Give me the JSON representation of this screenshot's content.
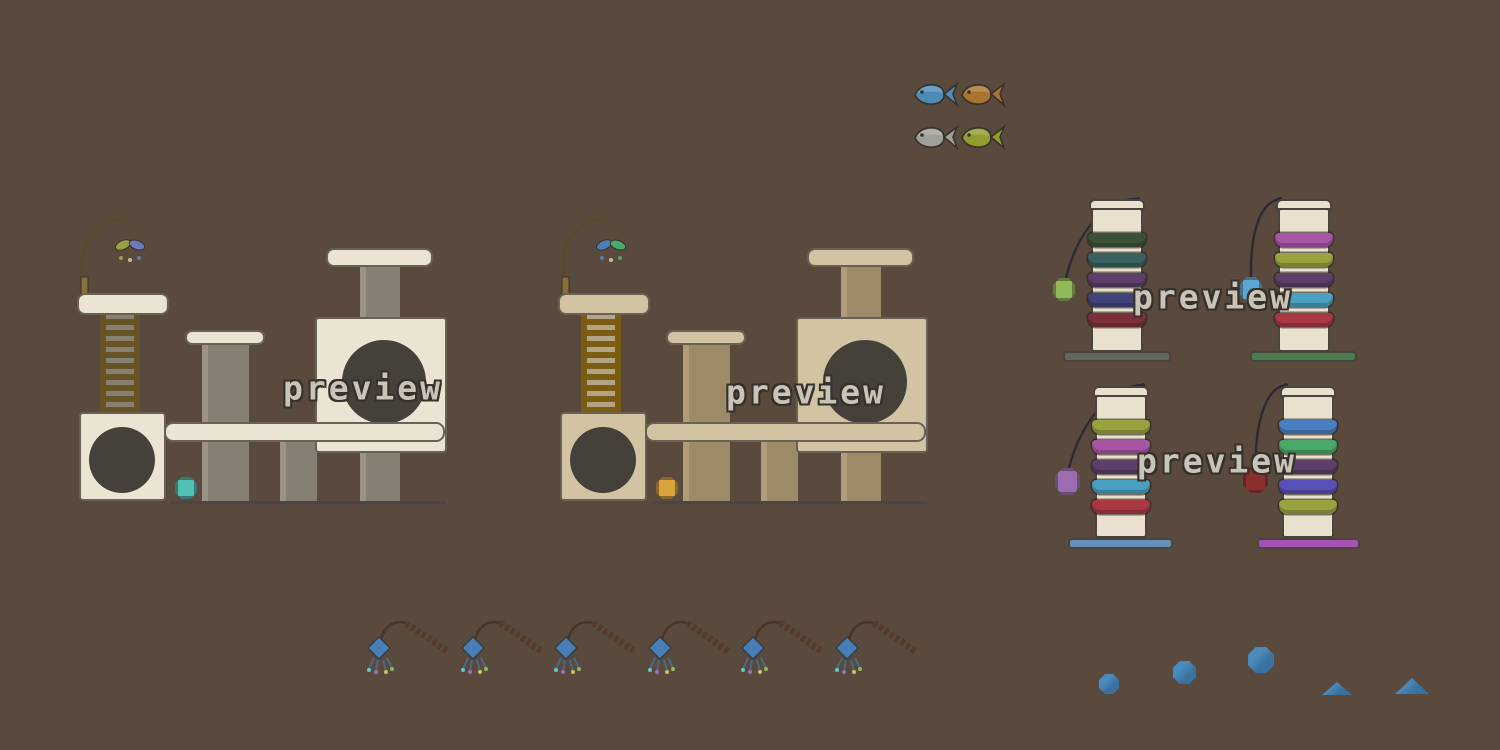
{
  "watermark": {
    "text": "preview",
    "count": 4
  },
  "palette": {
    "bg": "#5a4a3e",
    "outline": "#37312b",
    "preview_fill": "#c9c3b8",
    "baseline": "#42414f",
    "sprite_border": "#696155",
    "scratch_border": "#4a443c",
    "cream": "#ebe4d3",
    "tan": "#d2c3a2",
    "post_gray": "#878072",
    "post_gray_hi": "#9a9386",
    "post_tan": "#9d8a66",
    "post_tan_hi": "#b09d77",
    "ladder_rail_a": "#665426",
    "ladder_band_a": "#8a8070",
    "ladder_rail_b": "#7a5d13",
    "ladder_band_b": "#b3a584",
    "hole": "#45403a",
    "scratch_body": "#e9e1cd",
    "ball_teal": "#4fc0b4",
    "ball_orange": "#d9a33c",
    "ball_green": "#92b958",
    "ball_blue": "#5aa7d4",
    "ball_purple": "#9c6cb0",
    "ball_dark_red": "#8c2e2e",
    "base_gray": "#62655a",
    "base_green": "#4a7e50",
    "base_blue": "#6590bd",
    "base_magenta": "#a653b5",
    "stripe_dark_green": "#3b5138",
    "stripe_teal": "#39615f",
    "stripe_purple": "#5d3f69",
    "stripe_navy": "#414479",
    "stripe_dark_red": "#7c3039",
    "stripe_magenta": "#a855a5",
    "stripe_olive": "#9aa23f",
    "stripe_sky": "#4aa0c0",
    "stripe_red": "#a93844",
    "stripe_blue": "#4a7fc0",
    "stripe_green": "#4aa96a",
    "stripe_indigo": "#5a51b8",
    "feather_olive": "#9aa045",
    "feather_slate": "#6b79b8",
    "feather_blue": "#4a7fb5",
    "feather_green": "#4aa96a",
    "feather_tan": "#c9b98a",
    "fish_blue": "#4e8cb8",
    "fish_orange": "#a9742f",
    "fish_silver": "#9fa09a",
    "fish_green": "#939c2e",
    "string": "#2e2a33",
    "wand_rod": "#5b4a28",
    "wand_handle": "#8a6f3a",
    "toy_rod": "#4a3627",
    "toy_coil": "#553b2a",
    "toy_head": "#4a7fb5",
    "tassel_line": "#4a6a84",
    "tassel_cyan": "#62c7c9",
    "tassel_purple": "#a06cc0",
    "tassel_yellow": "#cfc05e",
    "tassel_green": "#8fba56",
    "toy_blue": "#39719f",
    "toy_blue_hi": "#4a8abc"
  },
  "sprites": {
    "fish": [
      {
        "name": "blue-fish",
        "color": "fish_blue"
      },
      {
        "name": "orange-fish",
        "color": "fish_orange"
      },
      {
        "name": "silver-fish",
        "color": "fish_silver"
      },
      {
        "name": "green-fish",
        "color": "fish_green"
      }
    ],
    "cat_trees": [
      {
        "name": "cat-tree-cream",
        "wood": "cream",
        "post": "post_gray",
        "ball": "ball_teal",
        "feathers": [
          "feather_olive",
          "feather_slate"
        ]
      },
      {
        "name": "cat-tree-tan",
        "wood": "tan",
        "post": "post_tan",
        "ball": "ball_orange",
        "feathers": [
          "feather_blue",
          "feather_green"
        ]
      }
    ],
    "scratching_posts": [
      {
        "name": "post-top-left",
        "stripes": [
          "stripe_dark_green",
          "stripe_teal",
          "stripe_purple",
          "stripe_navy",
          "stripe_dark_red"
        ],
        "base": "base_gray",
        "ball": "ball_green"
      },
      {
        "name": "post-top-right",
        "stripes": [
          "stripe_magenta",
          "stripe_olive",
          "stripe_purple",
          "stripe_sky",
          "stripe_red"
        ],
        "base": "base_green",
        "ball": "ball_blue"
      },
      {
        "name": "post-bottom-left",
        "stripes": [
          "stripe_olive",
          "stripe_magenta",
          "stripe_purple",
          "stripe_sky",
          "stripe_red"
        ],
        "base": "base_blue",
        "ball": "ball_purple"
      },
      {
        "name": "post-bottom-right",
        "stripes": [
          "stripe_blue",
          "stripe_green",
          "stripe_purple",
          "stripe_indigo",
          "stripe_olive"
        ],
        "base": "base_magenta",
        "ball": "ball_dark_red"
      }
    ],
    "wand_toys": {
      "count": 6
    },
    "loose_toys": {
      "balls": 3,
      "mounds": 2,
      "color": "toy_blue"
    }
  }
}
